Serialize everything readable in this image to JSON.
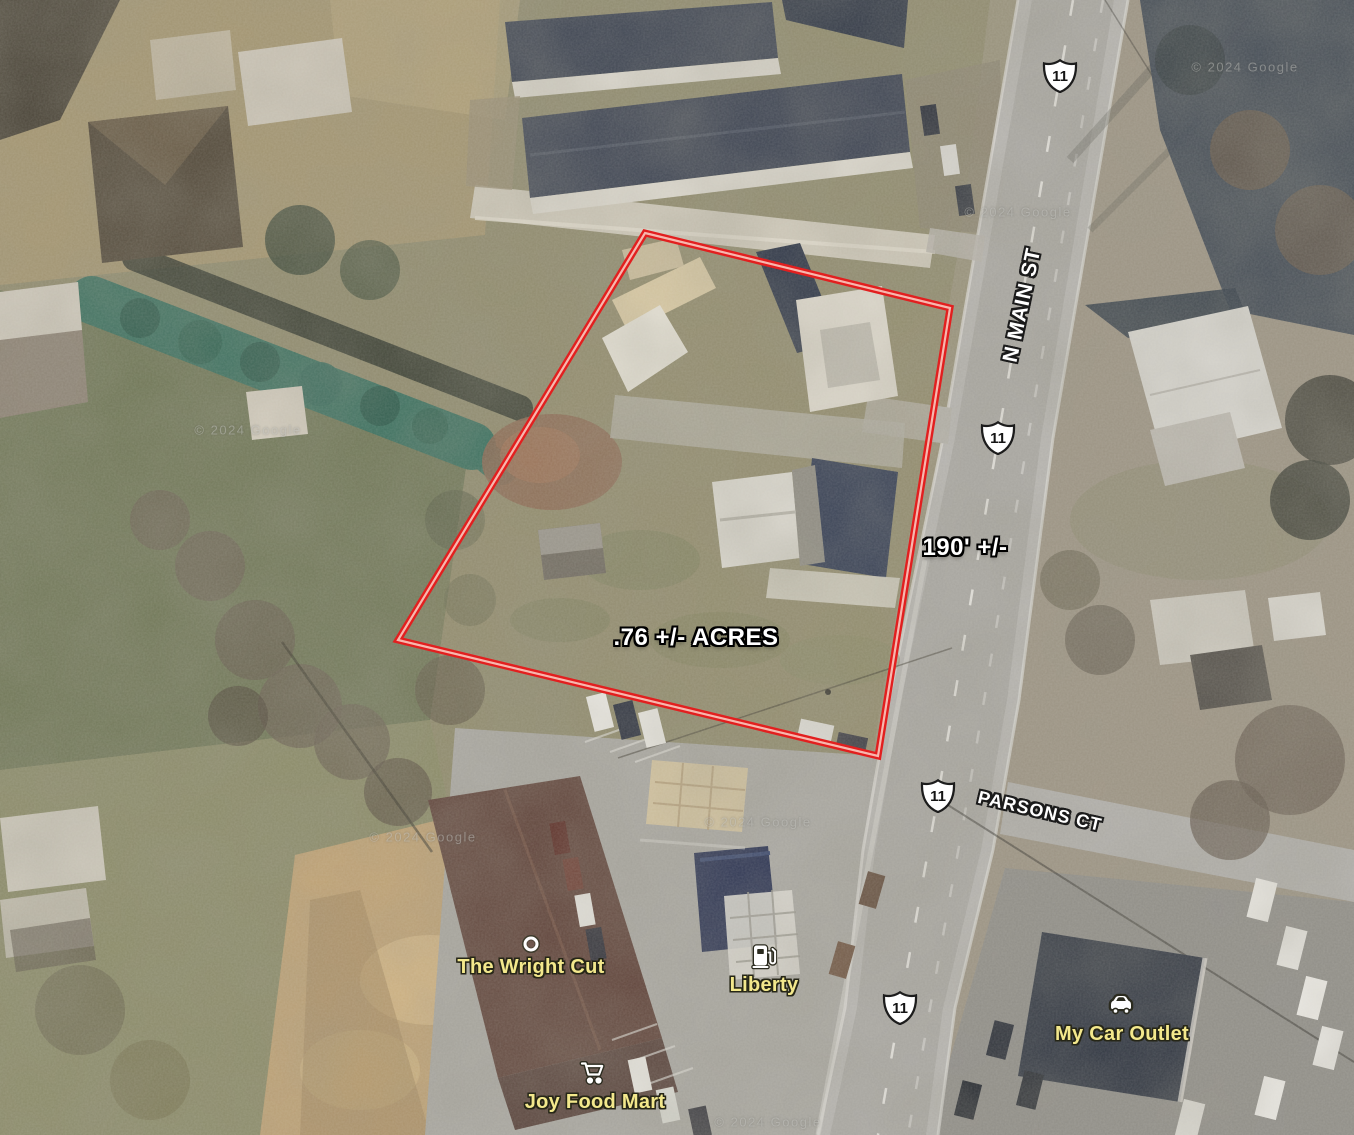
{
  "map": {
    "attribution": "© 2024 Google",
    "route_shield": {
      "number": "11"
    },
    "streets": {
      "n_main": "N MAIN ST",
      "parsons": "PARSONS CT"
    },
    "annotations": {
      "frontage": "190' +/-",
      "acreage": ".76 +/- ACRES",
      "boundary_color": "#e21f1f",
      "parcel_polygon_points": "645,233 950,308 878,756 398,640"
    },
    "pois": {
      "wright_cut": "The Wright Cut",
      "liberty": "Liberty",
      "joy_food_mart": "Joy Food Mart",
      "my_car_outlet": "My Car Outlet"
    }
  }
}
